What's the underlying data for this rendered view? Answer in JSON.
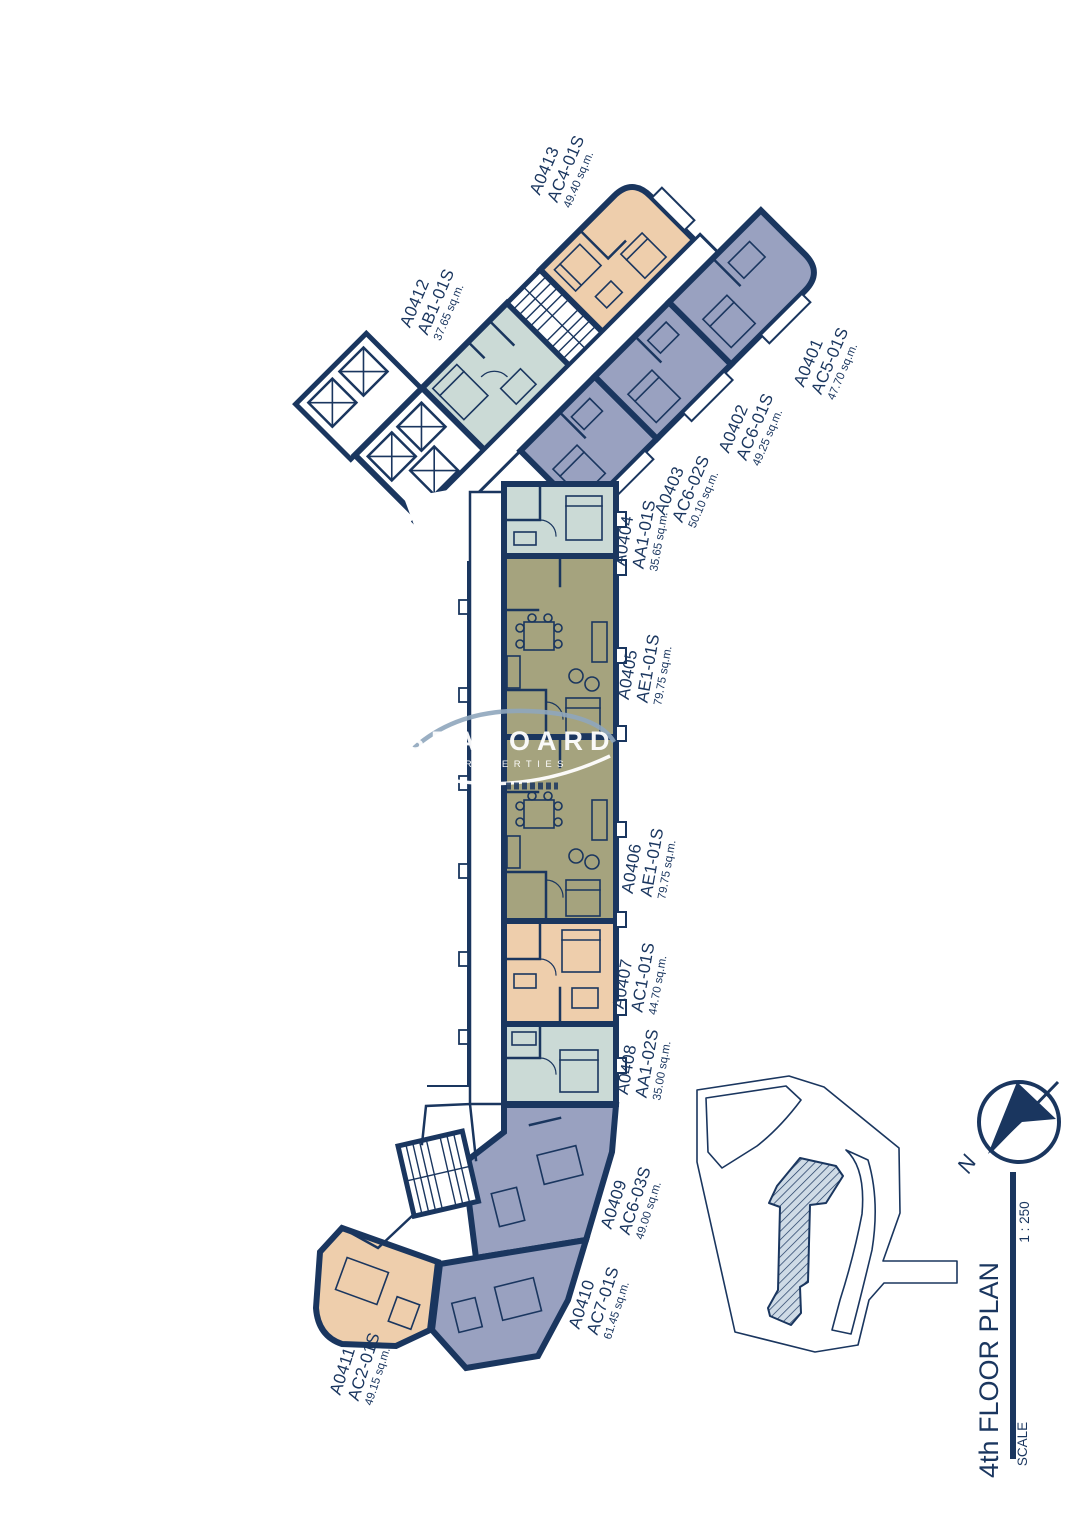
{
  "drawing": {
    "type_label": "residential floor plan"
  },
  "colors": {
    "wall": "#1a365f",
    "unit_peach": "#eeceac",
    "unit_teal": "#cbdad6",
    "unit_purple": "#99a1c0",
    "unit_olive": "#a5a37e",
    "watermark_swoosh": "#8fa6bd"
  },
  "units": [
    {
      "id": "A0401",
      "type_code": "AC5-01S",
      "area": "47.70 sq.m.",
      "color": "#99a1c0"
    },
    {
      "id": "A0402",
      "type_code": "AC6-01S",
      "area": "49.25 sq.m.",
      "color": "#99a1c0"
    },
    {
      "id": "A0403",
      "type_code": "AC6-02S",
      "area": "50.10 sq.m.",
      "color": "#99a1c0"
    },
    {
      "id": "A0404",
      "type_code": "AA1-01S",
      "area": "35.65 sq.m.",
      "color": "#cbdad6"
    },
    {
      "id": "A0405",
      "type_code": "AE1-01S",
      "area": "79.75 sq.m.",
      "color": "#a5a37e"
    },
    {
      "id": "A0406",
      "type_code": "AE1-01S",
      "area": "79.75 sq.m.",
      "color": "#a5a37e"
    },
    {
      "id": "A0407",
      "type_code": "AC1-01S",
      "area": "44.70 sq.m.",
      "color": "#eeceac"
    },
    {
      "id": "A0408",
      "type_code": "AA1-02S",
      "area": "35.00 sq.m.",
      "color": "#cbdad6"
    },
    {
      "id": "A0409",
      "type_code": "AC6-03S",
      "area": "49.00 sq.m.",
      "color": "#99a1c0"
    },
    {
      "id": "A0410",
      "type_code": "AC7-01S",
      "area": "61.45 sq.m.",
      "color": "#99a1c0"
    },
    {
      "id": "A0411",
      "type_code": "AC2-01S",
      "area": "49.15 sq.m.",
      "color": "#eeceac"
    },
    {
      "id": "A0412",
      "type_code": "AB1-01S",
      "area": "37.65 sq.m.",
      "color": "#cbdad6"
    },
    {
      "id": "A0413",
      "type_code": "AC4-01S",
      "area": "49.40 sq.m.",
      "color": "#eeceac"
    }
  ],
  "watermark": {
    "line1": "SEABOARD",
    "line2": "PROPERTIES"
  },
  "title_block": {
    "title": "4th FLOOR PLAN",
    "scale_label": "SCALE",
    "scale_value": "1 : 250"
  },
  "north_indicator": {
    "label": "N"
  }
}
